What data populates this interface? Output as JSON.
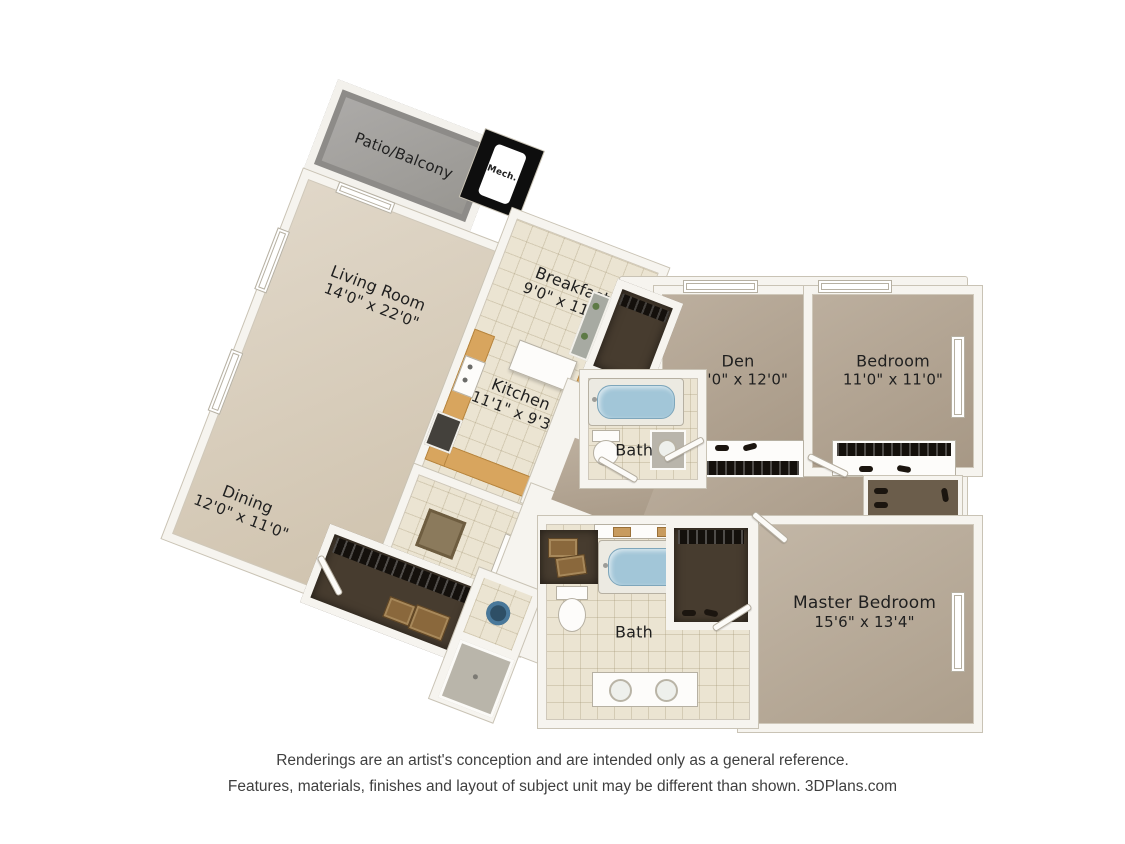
{
  "plan_title": "Two bedroom with den floor plan",
  "rooms": {
    "patio": {
      "name": "Patio/Balcony",
      "dims": ""
    },
    "living": {
      "name": "Living Room",
      "dims": "14'0\" x 22'0\""
    },
    "dining": {
      "name": "Dining",
      "dims": "12'0\" x 11'0\""
    },
    "breakfast": {
      "name": "Breakfast",
      "dims": "9'0\" x 11'0\""
    },
    "kitchen": {
      "name": "Kitchen",
      "dims": "11'1\" x 9'3\""
    },
    "mech": {
      "name": "Mech."
    },
    "bath_upper": {
      "name": "Bath"
    },
    "den": {
      "name": "Den",
      "dims": "10'0\" x 12'0\""
    },
    "bedroom": {
      "name": "Bedroom",
      "dims": "11'0\" x 11'0\""
    },
    "bath_master": {
      "name": "Bath"
    },
    "master": {
      "name": "Master Bedroom",
      "dims": "15'6\" x 13'4\""
    }
  },
  "footer": {
    "line1": "Renderings are an artist's conception and are intended only as a general reference.",
    "line2": "Features, materials, finishes and layout of subject unit may be different than shown. 3DPlans.com"
  },
  "colors": {
    "background": "#ffffff",
    "wall": "#f6f4ef",
    "wall_outline": "#c9c3b5",
    "floor_beige": "#d6cab6",
    "floor_tile": "#ebe4d2",
    "floor_carpet": "#b3a491",
    "floor_master": "#b9ab98",
    "patio_gray": "#a2a09d",
    "closet_dark": "#473c2f",
    "counter_tan": "#d8a55e",
    "tub_water": "#a2c6d8",
    "mech_black": "#0e0e0e",
    "label_text": "#1f1f1f",
    "footer_text": "#3f3f3f"
  }
}
